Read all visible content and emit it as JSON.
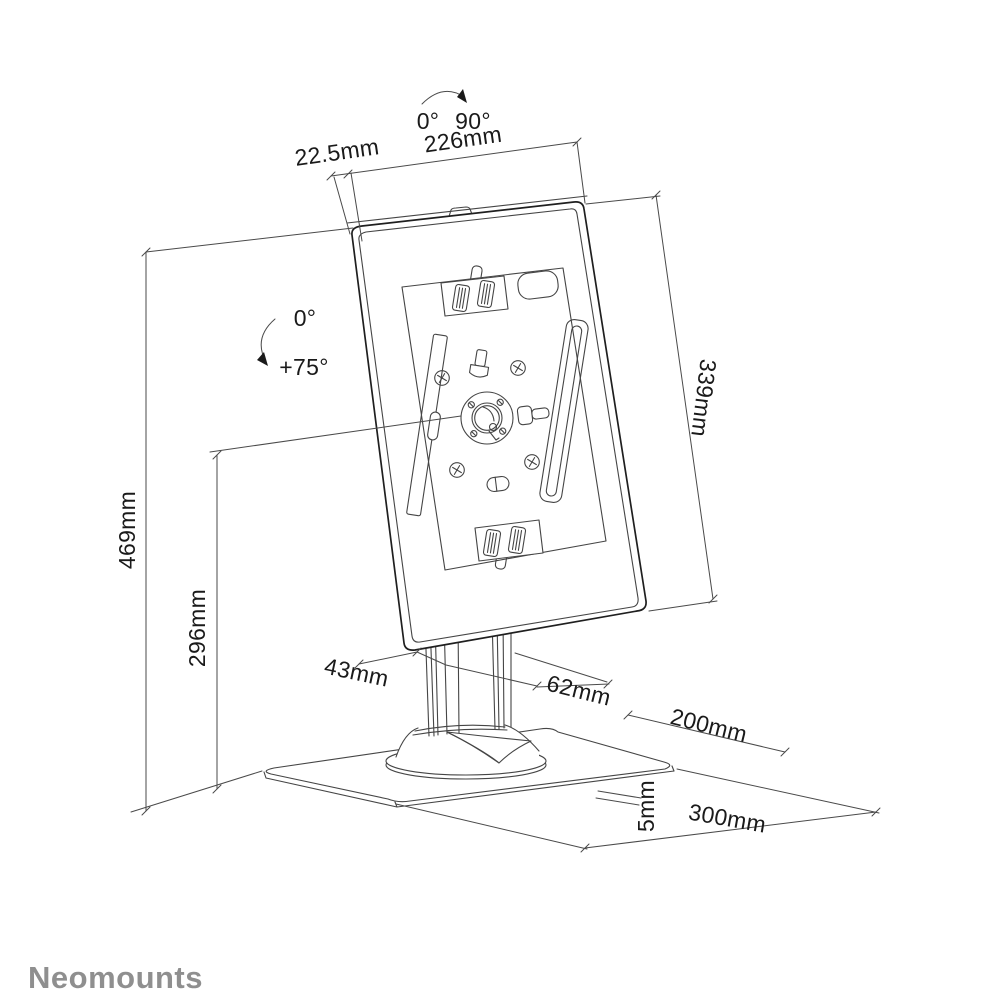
{
  "title": "Tablet desk stand dimensional drawing",
  "brand": {
    "name": "Neomounts"
  },
  "annotations": {
    "rotation_range": {
      "from": "0°",
      "to": "90°"
    },
    "tilt_range": {
      "from": "0°",
      "to": "+75°"
    }
  },
  "dimensions": {
    "top_offset": "22.5mm",
    "enclosure_width": "226mm",
    "enclosure_height": "339mm",
    "overall_height": "469mm",
    "pivot_height": "296mm",
    "front_column": "43mm",
    "rear_column": "62mm",
    "base_depth": "200mm",
    "base_thickness": "5mm",
    "base_width": "300mm"
  },
  "colors": {
    "line": "#454545",
    "edge_emphasis": "#1f1f1f",
    "text": "#1a1a1a",
    "brand": "#8f8f8f",
    "background": "#ffffff"
  }
}
